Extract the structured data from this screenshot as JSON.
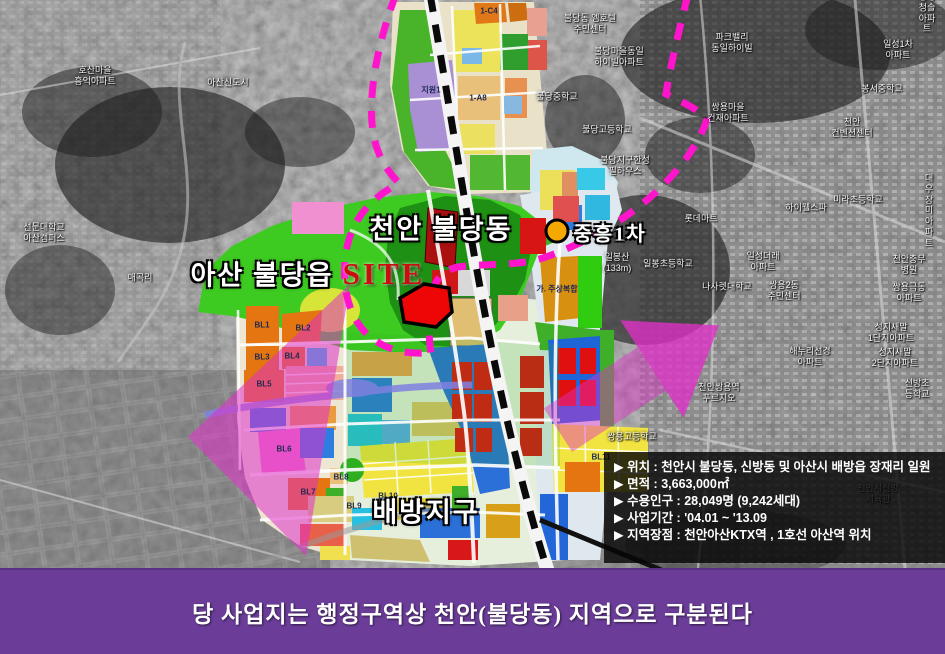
{
  "banner": {
    "text": "당 사업지는 행정구역상 천안(불당동) 지역으로 구분된다"
  },
  "info_box": {
    "items": [
      "▶ 위치 : 천안시 불당동, 신방동 및 아산시 배방읍 장재리 일원",
      "▶ 면적 : 3,663,000㎡",
      "▶ 수용인구 : 28,049명 (9,242세대)",
      "▶ 사업기간 : '04.01 ~ '13.09",
      "▶ 지역장점 : 천안아산KTX역 , 1호선 아산역 위치"
    ]
  },
  "district_labels": [
    {
      "text": "천안 불당동",
      "x": 441,
      "y": 227
    },
    {
      "text": "아산 불당읍",
      "x": 262,
      "y": 273
    },
    {
      "text": "SITE",
      "x": 384,
      "y": 274,
      "size": 31,
      "kind": "site"
    },
    {
      "text": "배방지구",
      "x": 426,
      "y": 510
    },
    {
      "text": "중흥1차",
      "x": 610,
      "y": 232,
      "size": 20
    }
  ],
  "zone_labels": [
    {
      "text": "BL1",
      "x": 262,
      "y": 325
    },
    {
      "text": "BL2",
      "x": 303,
      "y": 328
    },
    {
      "text": "BL3",
      "x": 262,
      "y": 357
    },
    {
      "text": "BL4",
      "x": 292,
      "y": 356
    },
    {
      "text": "BL5",
      "x": 264,
      "y": 384
    },
    {
      "text": "BL6",
      "x": 284,
      "y": 449
    },
    {
      "text": "BL7",
      "x": 308,
      "y": 492
    },
    {
      "text": "BL8",
      "x": 341,
      "y": 477
    },
    {
      "text": "BL9",
      "x": 354,
      "y": 506
    },
    {
      "text": "BL10",
      "x": 388,
      "y": 496
    },
    {
      "text": "BL11",
      "x": 601,
      "y": 457
    },
    {
      "text": "1-C4",
      "x": 489,
      "y": 11
    },
    {
      "text": "1-A8",
      "x": 478,
      "y": 98
    },
    {
      "text": "지원1",
      "x": 431,
      "y": 90
    },
    {
      "text": "가. 주상복합",
      "x": 557,
      "y": 289
    }
  ],
  "photo_labels": [
    {
      "text": "호산마을\n흥익아파트",
      "x": 95,
      "y": 76
    },
    {
      "text": "아산신도시",
      "x": 228,
      "y": 83
    },
    {
      "text": "선문대학교\n아산캠퍼스",
      "x": 44,
      "y": 233
    },
    {
      "text": "매곡리",
      "x": 140,
      "y": 278
    },
    {
      "text": "불당동 엠호텔\n주민센터",
      "x": 590,
      "y": 24
    },
    {
      "text": "불당마을동일\n하이빌아파트",
      "x": 619,
      "y": 57
    },
    {
      "text": "파크밸리\n동일하이빌",
      "x": 732,
      "y": 43
    },
    {
      "text": "봉명청솔\n아파트",
      "x": 927,
      "y": 13
    },
    {
      "text": "일성1차\n아파트",
      "x": 898,
      "y": 50
    },
    {
      "text": "봉서중학교",
      "x": 882,
      "y": 89
    },
    {
      "text": "쌍용마을\n건재아파트",
      "x": 728,
      "y": 113
    },
    {
      "text": "불당중학교",
      "x": 557,
      "y": 97
    },
    {
      "text": "불당고등학교",
      "x": 607,
      "y": 130
    },
    {
      "text": "불당지구한성\n필하우스",
      "x": 625,
      "y": 166
    },
    {
      "text": "롯데마트",
      "x": 701,
      "y": 219
    },
    {
      "text": "천안\n컨벤션센터",
      "x": 852,
      "y": 128
    },
    {
      "text": "미라초등학교",
      "x": 858,
      "y": 200
    },
    {
      "text": "대우장미\n아파트",
      "x": 929,
      "y": 211
    },
    {
      "text": "하이웰스파",
      "x": 806,
      "y": 208
    },
    {
      "text": "일봉산\n(133m)",
      "x": 617,
      "y": 263
    },
    {
      "text": "일봉초등학교",
      "x": 668,
      "y": 264
    },
    {
      "text": "나사렛대학교",
      "x": 727,
      "y": 287
    },
    {
      "text": "일성더래\n아파트",
      "x": 763,
      "y": 262
    },
    {
      "text": "천안충무병원",
      "x": 909,
      "y": 265
    },
    {
      "text": "쌍용2동\n주민센터",
      "x": 784,
      "y": 291
    },
    {
      "text": "쌍용극동\n아파트",
      "x": 909,
      "y": 293
    },
    {
      "text": "성지새말\n1단지아파트",
      "x": 891,
      "y": 333
    },
    {
      "text": "해누리선경\n아파트",
      "x": 810,
      "y": 357
    },
    {
      "text": "성지새말\n2단지아파트",
      "x": 895,
      "y": 358
    },
    {
      "text": "신방초등학교",
      "x": 917,
      "y": 389
    },
    {
      "text": "천안쌍용역\n푸르지오",
      "x": 719,
      "y": 393
    },
    {
      "text": "쌍용고등학교",
      "x": 632,
      "y": 437
    },
    {
      "text": "천안시신방\n체육관",
      "x": 878,
      "y": 494
    }
  ],
  "colors": {
    "banner_purple": "#6b3d99",
    "boundary_magenta": "#ff14cc",
    "arrow_magenta": "#e02fc8",
    "site_red": "#cc0d0d",
    "site_parcel_fill": "#ee0505",
    "marker_yellow": "#f5a800",
    "park_green": "#3ecb21",
    "forest_green": "#1e9013",
    "block_orange": "#e57510",
    "block_blue": "#2a70d8",
    "block_red": "#d81212"
  }
}
